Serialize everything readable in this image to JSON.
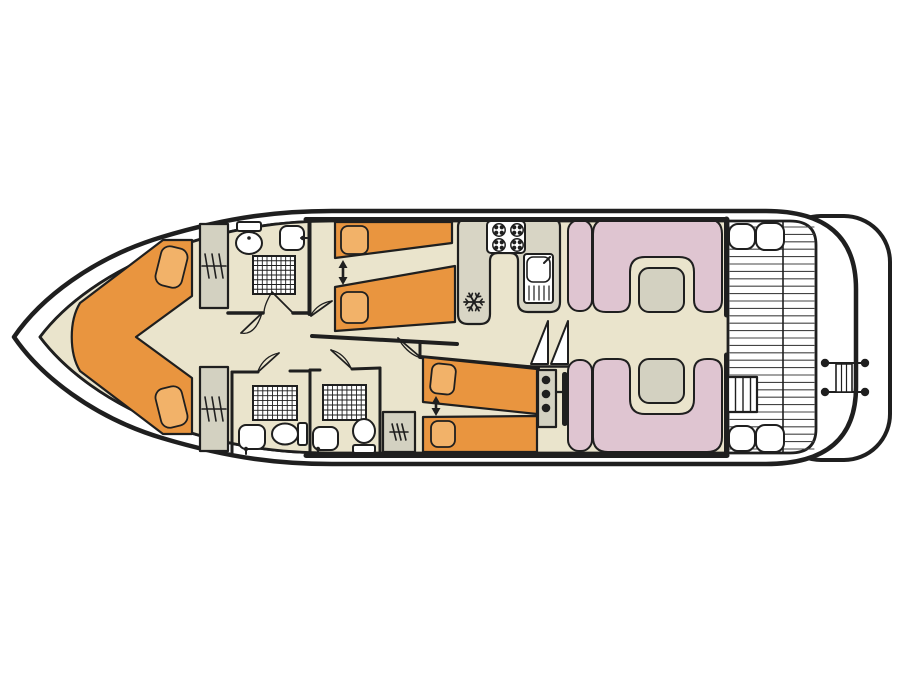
{
  "canvas": {
    "width": 900,
    "height": 675,
    "background": "#ffffff"
  },
  "colors": {
    "ink": "#1f1f1f",
    "floor": "#EAE4CC",
    "orange": "#E9953F",
    "pillow": "#F2B269",
    "pink": "#DFC5D1",
    "gray": "#D3D1C1",
    "counter": "#D8D5C5",
    "white": "#ffffff",
    "deckline": "#444444"
  },
  "shapes": [
    {
      "name": "swim-platform",
      "type": "rect",
      "x": 775,
      "y": 216,
      "w": 115,
      "h": 244,
      "rx": 46,
      "fill": "white",
      "sw": 4
    },
    {
      "name": "hull-outline",
      "type": "path",
      "d": "M 14 337 C 40 299 92 258 162 237 C 232 216 282 211 332 211 L 766 211 Q 856 211 856 289 L 856 387 Q 856 464 766 464 L 332 464 C 282 464 232 459 162 438 C 92 417 40 375 14 337 Z",
      "fill": "white",
      "sw": 4.5
    },
    {
      "name": "inner-deck-outline",
      "type": "path",
      "d": "M 40 337 C 64 305 108 271 170 249 C 232 227 284 221 332 221 L 790 221 Q 816 221 816 245 L 816 429 Q 816 453 790 453 L 332 453 C 284 453 232 448 170 426 C 108 404 64 369 40 337 Z",
      "fill": "white",
      "sw": 2.8
    },
    {
      "name": "cabin-floor",
      "type": "path",
      "d": "M 40 337 C 64 305 108 271 170 249 C 232 227 284 221 332 221 L 728 221 L 728 453 L 332 453 C 284 453 232 448 170 426 C 108 404 64 369 40 337 Z",
      "fill": "floor",
      "sw": 2.8
    },
    {
      "name": "deck-planks",
      "type": "hlines",
      "x1": 730,
      "x2": 814,
      "y1": 227,
      "y2": 450,
      "step": 7.4,
      "sw": 1.1,
      "stroke": "deckline"
    },
    {
      "name": "deck-divider",
      "type": "line",
      "x1": 783,
      "y1": 222,
      "x2": 783,
      "y2": 452,
      "sw": 1.6
    },
    {
      "name": "deck-seat",
      "type": "rect",
      "x": 729,
      "y": 224,
      "w": 26,
      "h": 25,
      "rx": 9,
      "fill": "white",
      "sw": 2
    },
    {
      "name": "deck-seat",
      "type": "rect",
      "x": 756,
      "y": 223,
      "w": 28,
      "h": 27,
      "rx": 9,
      "fill": "white",
      "sw": 2
    },
    {
      "name": "deck-seat",
      "type": "rect",
      "x": 729,
      "y": 426,
      "w": 26,
      "h": 25,
      "rx": 9,
      "fill": "white",
      "sw": 2
    },
    {
      "name": "deck-seat",
      "type": "rect",
      "x": 756,
      "y": 425,
      "w": 28,
      "h": 27,
      "rx": 9,
      "fill": "white",
      "sw": 2
    },
    {
      "name": "deck-steps",
      "type": "rect",
      "x": 728,
      "y": 377,
      "w": 29,
      "h": 35,
      "fill": "white",
      "sw": 2.2
    },
    {
      "name": "deck-steps-treads",
      "type": "vlines",
      "xs": [
        735.5,
        743,
        750.5
      ],
      "y1": 377,
      "y2": 412,
      "sw": 1.4
    },
    {
      "name": "stern-ladder-rail",
      "type": "line",
      "x1": 822,
      "y1": 363,
      "x2": 868,
      "y2": 363,
      "sw": 2
    },
    {
      "name": "stern-ladder-rail",
      "type": "line",
      "x1": 822,
      "y1": 392,
      "x2": 868,
      "y2": 392,
      "sw": 2
    },
    {
      "name": "stern-ladder",
      "type": "rect",
      "x": 836,
      "y": 364,
      "w": 16,
      "h": 28,
      "fill": "white",
      "sw": 1.6
    },
    {
      "name": "stern-ladder-rungs",
      "type": "vlines",
      "xs": [
        841.5,
        846.5
      ],
      "y1": 364,
      "y2": 392,
      "sw": 1.2
    },
    {
      "name": "stern-cleats",
      "type": "dots",
      "pts": [
        [
          825,
          363
        ],
        [
          865,
          363
        ],
        [
          825,
          392
        ],
        [
          865,
          392
        ]
      ],
      "r": 4.2
    },
    {
      "name": "bed-vberth",
      "type": "path",
      "d": "M 80 303 L 163 240 L 192 240 L 192 296 L 136 337 L 192 378 L 192 434 L 163 434 L 80 371 C 69 353 69 321 80 303 Z",
      "fill": "orange",
      "sw": 2.2
    },
    {
      "name": "pillow",
      "type": "rect",
      "x": 158,
      "y": 247,
      "w": 27,
      "h": 40,
      "rx": 9,
      "rot": 14,
      "fill": "pillow",
      "sw": 1.8
    },
    {
      "name": "pillow",
      "type": "rect",
      "x": 158,
      "y": 387,
      "w": 27,
      "h": 40,
      "rx": 9,
      "rot": -14,
      "fill": "pillow",
      "sw": 1.8
    },
    {
      "name": "wardrobe",
      "type": "rect",
      "x": 200,
      "y": 224,
      "w": 28,
      "h": 84,
      "fill": "gray",
      "sw": 2.2
    },
    {
      "name": "wardrobe-hanger-icon",
      "type": "hanger",
      "cx": 214,
      "cy": 266,
      "w": 20,
      "h": 24
    },
    {
      "name": "wardrobe",
      "type": "rect",
      "x": 200,
      "y": 367,
      "w": 28,
      "h": 84,
      "fill": "gray",
      "sw": 2.2
    },
    {
      "name": "wardrobe-hanger-icon",
      "type": "hanger",
      "cx": 214,
      "cy": 409,
      "w": 20,
      "h": 24
    },
    {
      "name": "toilet-tank",
      "type": "rect",
      "x": 237,
      "y": 222,
      "w": 24,
      "h": 9,
      "rx": 2,
      "fill": "white",
      "sw": 2
    },
    {
      "name": "toilet-bowl",
      "type": "ellipse",
      "cx": 249,
      "cy": 243,
      "rx": 13,
      "ry": 11,
      "fill": "white",
      "sw": 2
    },
    {
      "name": "toilet-flush-dot",
      "type": "dots",
      "pts": [
        [
          249,
          238
        ]
      ],
      "r": 1.8
    },
    {
      "name": "sink-basin",
      "type": "rect",
      "x": 280,
      "y": 226,
      "w": 24,
      "h": 24,
      "rx": 7,
      "fill": "white",
      "sw": 2
    },
    {
      "name": "sink-tap",
      "type": "line",
      "x1": 301,
      "y1": 238,
      "x2": 307,
      "y2": 238,
      "sw": 2
    },
    {
      "name": "sink-tap-dot",
      "type": "dots",
      "pts": [
        [
          303,
          238
        ]
      ],
      "r": 2.3
    },
    {
      "name": "shower-tray",
      "type": "grid",
      "x": 253,
      "y": 256,
      "w": 42,
      "h": 38,
      "cols": 9,
      "rows": 8
    },
    {
      "name": "wall",
      "type": "line",
      "x1": 309.5,
      "y1": 221,
      "x2": 309.5,
      "y2": 314,
      "sw": 4
    },
    {
      "name": "wall",
      "type": "line",
      "x1": 228,
      "y1": 313,
      "x2": 263,
      "y2": 313,
      "sw": 3.5
    },
    {
      "name": "wall",
      "type": "line",
      "x1": 293,
      "y1": 313,
      "x2": 309,
      "y2": 313,
      "sw": 3.5
    },
    {
      "name": "door",
      "type": "door",
      "leaf": [
        293,
        313,
        272,
        292
      ],
      "arc": "M 272 292 Q 264 305 264 313"
    },
    {
      "name": "door",
      "type": "door",
      "leaf": [
        262,
        313,
        241,
        333
      ],
      "arc": "M 241 333 Q 255 336 262 313"
    },
    {
      "name": "door",
      "type": "door",
      "leaf": [
        311,
        316,
        332,
        301
      ],
      "arc": "M 332 301 Q 318 303 311 315"
    },
    {
      "name": "bed-single",
      "type": "poly",
      "pts": "335,222 452,222 452,243 335,258",
      "fill": "orange",
      "sw": 2.2
    },
    {
      "name": "pillow",
      "type": "rect",
      "x": 341,
      "y": 226,
      "w": 27,
      "h": 28,
      "rx": 7,
      "fill": "pillow",
      "sw": 1.8
    },
    {
      "name": "beds-join-arrow",
      "type": "varrow",
      "x": 343,
      "y1": 260,
      "y2": 285
    },
    {
      "name": "bed-single",
      "type": "poly",
      "pts": "335,287 455,266 455,322 335,331",
      "fill": "orange",
      "sw": 2.2
    },
    {
      "name": "pillow",
      "type": "rect",
      "x": 341,
      "y": 292,
      "w": 27,
      "h": 31,
      "rx": 7,
      "fill": "pillow",
      "sw": 1.8
    },
    {
      "name": "wall",
      "type": "line",
      "x1": 312,
      "y1": 336,
      "x2": 457,
      "y2": 344,
      "sw": 4
    },
    {
      "name": "galley-counter",
      "type": "path",
      "d": "M 458 227 Q 458 219 466 219 L 552 219 Q 560 219 560 227 L 560 302 Q 560 312 550 312 L 528 312 Q 518 312 518 302 L 518 261 Q 518 253 510 253 L 498 253 Q 490 253 490 261 L 490 314 Q 490 324 480 324 L 468 324 Q 458 324 458 314 Z",
      "fill": "counter",
      "sw": 2.2
    },
    {
      "name": "stove",
      "type": "rect",
      "x": 487,
      "y": 221,
      "w": 38,
      "h": 32,
      "rx": 4,
      "fill": "white",
      "sw": 2
    },
    {
      "name": "stove-burner-icon",
      "type": "burner",
      "cx": 499,
      "cy": 230,
      "r": 6.2
    },
    {
      "name": "stove-burner-icon",
      "type": "burner",
      "cx": 517,
      "cy": 230,
      "r": 6.2
    },
    {
      "name": "stove-burner-icon",
      "type": "burner",
      "cx": 499,
      "cy": 245,
      "r": 6.2
    },
    {
      "name": "stove-burner-icon",
      "type": "burner",
      "cx": 517,
      "cy": 245,
      "r": 6.2
    },
    {
      "name": "galley-sink-unit",
      "type": "rect",
      "x": 524,
      "y": 254,
      "w": 29,
      "h": 49,
      "rx": 3,
      "fill": "white",
      "sw": 2
    },
    {
      "name": "galley-sink-basin",
      "type": "rect",
      "x": 527,
      "y": 257,
      "w": 23,
      "h": 25,
      "rx": 6,
      "fill": "white",
      "sw": 1.6
    },
    {
      "name": "galley-sink-tap",
      "type": "line",
      "x1": 544,
      "y1": 263,
      "x2": 550,
      "y2": 257,
      "sw": 2
    },
    {
      "name": "galley-drainboard",
      "type": "vlines",
      "xs": [
        529,
        534,
        539,
        544,
        549
      ],
      "y1": 286,
      "y2": 300,
      "sw": 1.2
    },
    {
      "name": "fridge-snowflake-icon",
      "type": "snow",
      "cx": 474,
      "cy": 302,
      "r": 10
    },
    {
      "name": "stairs-step",
      "type": "path",
      "d": "M 531 364 L 548 364 L 548 321 Z",
      "fill": "white",
      "sw": 2
    },
    {
      "name": "stairs-step",
      "type": "path",
      "d": "M 551 364 L 568 364 L 568 321 Z",
      "fill": "white",
      "sw": 2
    },
    {
      "name": "stairs-base",
      "type": "line",
      "x1": 528,
      "y1": 366.5,
      "x2": 570,
      "y2": 366.5,
      "sw": 2.5
    },
    {
      "name": "wall",
      "type": "line",
      "x1": 420,
      "y1": 357,
      "x2": 538,
      "y2": 368,
      "sw": 4
    },
    {
      "name": "wall",
      "type": "line",
      "x1": 420,
      "y1": 342,
      "x2": 420,
      "y2": 357,
      "sw": 3
    },
    {
      "name": "door",
      "type": "door",
      "leaf": [
        419,
        356,
        398,
        338
      ],
      "arc": "M 398 338 Q 406 352 418 357"
    },
    {
      "name": "bed-single",
      "type": "poly",
      "pts": "423,357 537,369 537,414 423,402",
      "fill": "orange",
      "sw": 2.2
    },
    {
      "name": "pillow",
      "type": "rect",
      "x": 431,
      "y": 364,
      "w": 24,
      "h": 30,
      "rx": 7,
      "rot": 6,
      "fill": "pillow",
      "sw": 1.8
    },
    {
      "name": "beds-join-arrow",
      "type": "varrow",
      "x": 436,
      "y1": 396,
      "y2": 416
    },
    {
      "name": "bed-single",
      "type": "poly",
      "pts": "423,417 537,416 537,452 423,452",
      "fill": "orange",
      "sw": 2.2
    },
    {
      "name": "pillow",
      "type": "rect",
      "x": 431,
      "y": 421,
      "w": 24,
      "h": 26,
      "rx": 7,
      "fill": "pillow",
      "sw": 1.8
    },
    {
      "name": "helm-console",
      "type": "rect",
      "x": 538,
      "y": 370,
      "w": 18,
      "h": 57,
      "fill": "gray",
      "sw": 2.2
    },
    {
      "name": "helm-instrument-dots",
      "type": "dots",
      "pts": [
        [
          546,
          380
        ],
        [
          546,
          394
        ],
        [
          546,
          408
        ]
      ],
      "r": 4.3
    },
    {
      "name": "steering-wheel",
      "type": "rect",
      "x": 562,
      "y": 372,
      "w": 5.5,
      "h": 54,
      "rx": 2.5,
      "fill": "ink",
      "sw": 0
    },
    {
      "name": "steering-wheel-link",
      "type": "line",
      "x1": 556,
      "y1": 392,
      "x2": 562,
      "y2": 392,
      "sw": 2.2
    },
    {
      "name": "wall",
      "type": "line",
      "x1": 232,
      "y1": 372,
      "x2": 232,
      "y2": 453,
      "sw": 3
    },
    {
      "name": "wall",
      "type": "line",
      "x1": 310,
      "y1": 370,
      "x2": 310,
      "y2": 453,
      "sw": 3
    },
    {
      "name": "wall",
      "type": "line",
      "x1": 380,
      "y1": 368,
      "x2": 380,
      "y2": 453,
      "sw": 3
    },
    {
      "name": "wall",
      "type": "line",
      "x1": 232,
      "y1": 372,
      "x2": 258,
      "y2": 372,
      "sw": 3
    },
    {
      "name": "wall",
      "type": "line",
      "x1": 290,
      "y1": 371,
      "x2": 310,
      "y2": 371,
      "sw": 3
    },
    {
      "name": "wall",
      "type": "line",
      "x1": 310,
      "y1": 370,
      "x2": 320,
      "y2": 370,
      "sw": 3
    },
    {
      "name": "wall",
      "type": "line",
      "x1": 352,
      "y1": 369,
      "x2": 380,
      "y2": 368,
      "sw": 3
    },
    {
      "name": "door",
      "type": "door",
      "leaf": [
        258,
        372,
        279,
        353
      ],
      "arc": "M 279 353 Q 264 356 258 371"
    },
    {
      "name": "door",
      "type": "door",
      "leaf": [
        352,
        369,
        331,
        350
      ],
      "arc": "M 331 350 Q 344 353 351 368"
    },
    {
      "name": "shower-tray",
      "type": "grid",
      "x": 253,
      "y": 386,
      "w": 44,
      "h": 34,
      "cols": 9,
      "rows": 7
    },
    {
      "name": "sink-basin",
      "type": "rect",
      "x": 239,
      "y": 425,
      "w": 26,
      "h": 24,
      "rx": 7,
      "fill": "white",
      "sw": 2
    },
    {
      "name": "sink-tap",
      "type": "line",
      "x1": 246,
      "y1": 448,
      "x2": 246,
      "y2": 454,
      "sw": 2
    },
    {
      "name": "sink-tap-dot",
      "type": "dots",
      "pts": [
        [
          246,
          449
        ]
      ],
      "r": 2.2
    },
    {
      "name": "toilet-bowl",
      "type": "ellipse",
      "cx": 285,
      "cy": 434,
      "rx": 13,
      "ry": 10.5,
      "fill": "white",
      "sw": 2
    },
    {
      "name": "toilet-tank",
      "type": "rect",
      "x": 298,
      "y": 423,
      "w": 9,
      "h": 22,
      "rx": 2,
      "fill": "white",
      "sw": 2
    },
    {
      "name": "sink-basin",
      "type": "rect",
      "x": 313,
      "y": 427,
      "w": 25,
      "h": 23,
      "rx": 7,
      "fill": "white",
      "sw": 2
    },
    {
      "name": "sink-tap",
      "type": "line",
      "x1": 318,
      "y1": 449,
      "x2": 318,
      "y2": 454,
      "sw": 2
    },
    {
      "name": "sink-tap-dot",
      "type": "dots",
      "pts": [
        [
          318,
          449
        ]
      ],
      "r": 2.2
    },
    {
      "name": "shower-tray",
      "type": "grid",
      "x": 323,
      "y": 385,
      "w": 43,
      "h": 35,
      "cols": 9,
      "rows": 7
    },
    {
      "name": "toilet-bowl",
      "type": "ellipse",
      "cx": 364,
      "cy": 431,
      "rx": 11,
      "ry": 12,
      "fill": "white",
      "sw": 2
    },
    {
      "name": "toilet-tank",
      "type": "rect",
      "x": 353,
      "y": 445,
      "w": 22,
      "h": 8,
      "rx": 2,
      "fill": "white",
      "sw": 2
    },
    {
      "name": "wardrobe",
      "type": "rect",
      "x": 383,
      "y": 412,
      "w": 32,
      "h": 40,
      "fill": "gray",
      "sw": 2.2
    },
    {
      "name": "wardrobe-hanger-icon",
      "type": "hanger",
      "cx": 399,
      "cy": 432,
      "w": 14,
      "h": 16
    },
    {
      "name": "saloon-bench",
      "type": "rect",
      "x": 568,
      "y": 220,
      "w": 24,
      "h": 91,
      "rx": 11,
      "fill": "pink",
      "sw": 2
    },
    {
      "name": "saloon-bench-u",
      "type": "path",
      "d": "M 593 234 Q 593 219 608 219 L 707 219 Q 722 219 722 234 L 722 300 Q 722 312 710 312 L 707 312 Q 694 312 694 300 L 694 272 Q 694 257 679 257 L 645 257 Q 630 257 630 272 L 630 300 Q 630 312 618 312 L 606 312 Q 593 312 593 300 Z",
      "fill": "pink",
      "sw": 2
    },
    {
      "name": "saloon-table",
      "type": "rect",
      "x": 639,
      "y": 268,
      "w": 45,
      "h": 44,
      "rx": 10,
      "fill": "gray",
      "sw": 2
    },
    {
      "name": "saloon-bench",
      "type": "rect",
      "x": 568,
      "y": 360,
      "w": 24,
      "h": 91,
      "rx": 11,
      "fill": "pink",
      "sw": 2
    },
    {
      "name": "saloon-bench-u",
      "type": "path",
      "d": "M 593 437 Q 593 452 608 452 L 707 452 Q 722 452 722 437 L 722 371 Q 722 359 710 359 L 707 359 Q 694 359 694 371 L 694 399 Q 694 414 679 414 L 645 414 Q 630 414 630 399 L 630 371 Q 630 359 618 359 L 606 359 Q 593 359 593 371 Z",
      "fill": "pink",
      "sw": 2
    },
    {
      "name": "saloon-table",
      "type": "rect",
      "x": 639,
      "y": 359,
      "w": 45,
      "h": 44,
      "rx": 10,
      "fill": "gray",
      "sw": 2
    },
    {
      "name": "wall-main",
      "type": "line",
      "x1": 306,
      "y1": 219.5,
      "x2": 727,
      "y2": 219.5,
      "sw": 5
    },
    {
      "name": "wall-main",
      "type": "line",
      "x1": 306,
      "y1": 455.5,
      "x2": 727,
      "y2": 455.5,
      "sw": 5
    },
    {
      "name": "wall-main",
      "type": "line",
      "x1": 726.5,
      "y1": 219,
      "x2": 726.5,
      "y2": 315,
      "sw": 5
    },
    {
      "name": "wall-main",
      "type": "line",
      "x1": 726.5,
      "y1": 355,
      "x2": 726.5,
      "y2": 453,
      "sw": 5
    }
  ]
}
